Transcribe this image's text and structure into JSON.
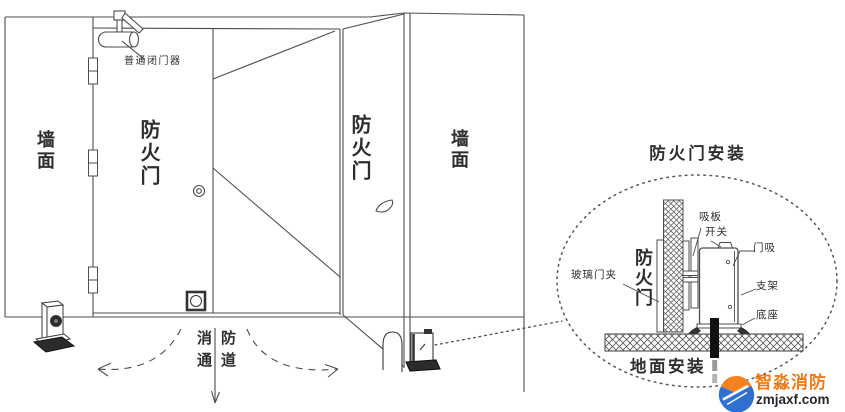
{
  "colors": {
    "line": "#4d4d4d",
    "dark_fill": "#2b2b2b",
    "brand_orange": "#ee7a18",
    "site_dark": "#26262e",
    "logo_blue": "#2f6fd0",
    "logo_orange": "#f5821f",
    "background": "#ffffff"
  },
  "scene": {
    "door_closer_label": "普通闭门器",
    "left_wall_label": "墙面",
    "closed_door_label": "防火门",
    "open_door_label": "防火门",
    "right_wall_label": "墙面",
    "passage_left_col": "消通",
    "passage_right_col": "防道"
  },
  "detail": {
    "title": "防火门安装",
    "suction_plate_label": "吸板",
    "switch_label": "开关",
    "door_magnet_label": "门吸",
    "bracket_label": "支架",
    "base_label": "底座",
    "glass_clamp_label": "玻璃门夹",
    "fire_door_label": "防火门",
    "floor_install_label": "地面安装"
  },
  "watermark": {
    "brand": "智淼消防",
    "site": "zmjaxf.com"
  }
}
